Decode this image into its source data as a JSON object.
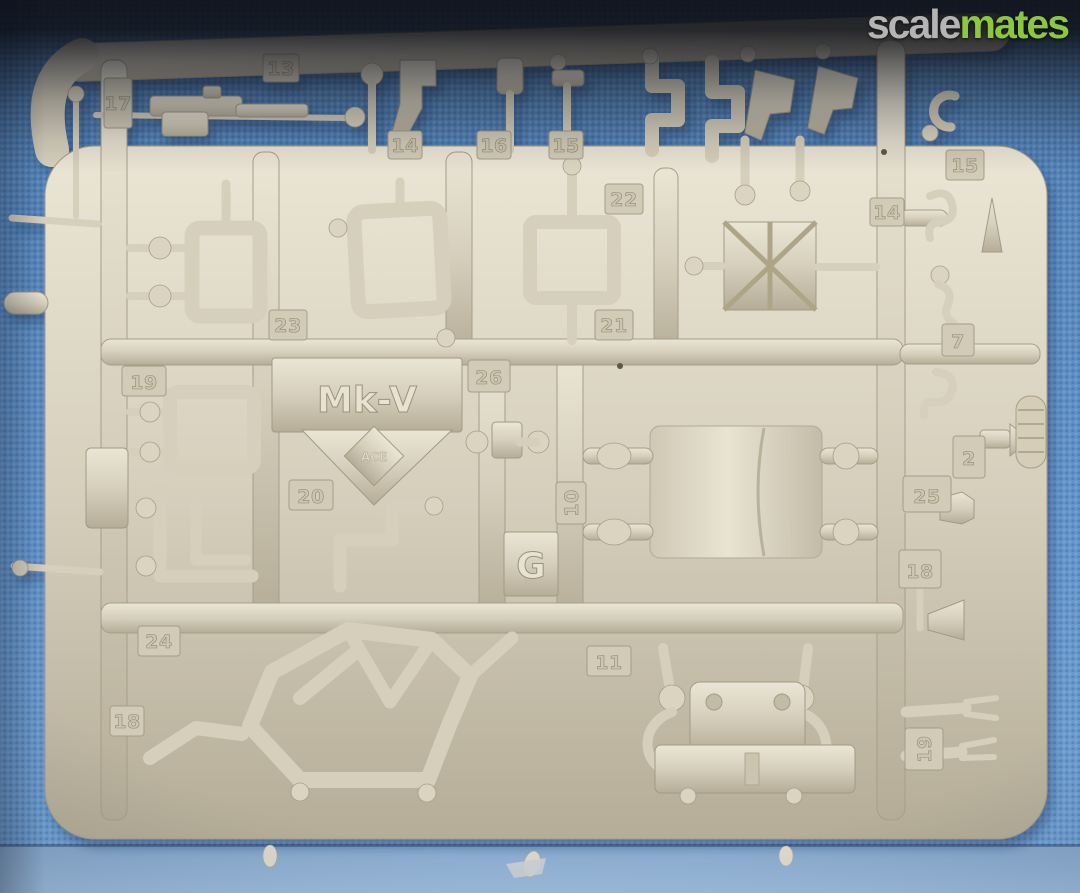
{
  "watermark": {
    "scale": "scale",
    "mates": "mates"
  },
  "sprue_plate": {
    "model": "Mk-V",
    "maker": "ACE",
    "sprue_letter": "G"
  },
  "part_tags": [
    {
      "label": "13"
    },
    {
      "label": "17"
    },
    {
      "label": "14"
    },
    {
      "label": "16"
    },
    {
      "label": "15"
    },
    {
      "label": "22"
    },
    {
      "label": "14"
    },
    {
      "label": "15"
    },
    {
      "label": "23"
    },
    {
      "label": "21"
    },
    {
      "label": "26"
    },
    {
      "label": "19"
    },
    {
      "label": "20"
    },
    {
      "label": "10"
    },
    {
      "label": "24"
    },
    {
      "label": "18"
    },
    {
      "label": "11"
    },
    {
      "label": "7"
    },
    {
      "label": "2"
    },
    {
      "label": "25"
    },
    {
      "label": "18"
    },
    {
      "label": "19"
    }
  ],
  "colors": {
    "background_fabric": "#5e8fc4",
    "bottom_fabric": "#93b4d6",
    "sprue_plastic": "#d9d2bf",
    "watermark_gray": "#b4b4b4",
    "watermark_green": "#8dc63f",
    "top_overlay": "#14161c"
  }
}
